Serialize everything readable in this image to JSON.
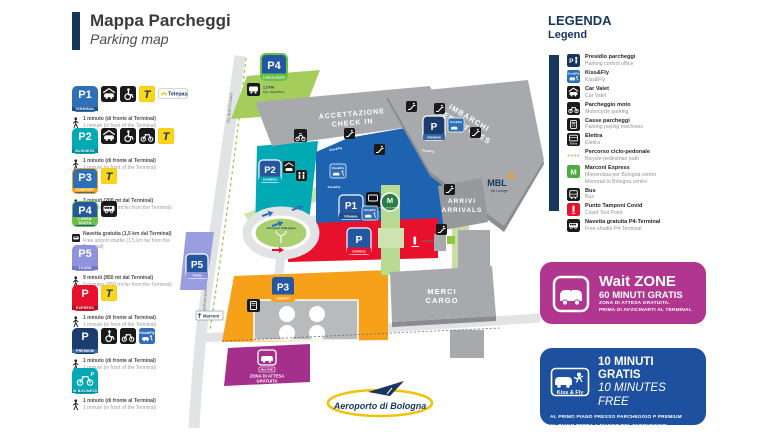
{
  "title": {
    "it": "Mappa Parcheggi",
    "en": "Parking map"
  },
  "labels": {
    "telepass_badge": "Telepass",
    "telepass_t": "T",
    "kissfly": "Kiss&Fly",
    "elettra": "Elettra",
    "marconi_m": "M",
    "office_p": "P",
    "kissfly_spaced": "Kiss & Fly"
  },
  "colors": {
    "navy": "#17365d",
    "p1_blue": "#1e63b0",
    "p2_teal": "#00aab4",
    "p3_orange": "#f7a11a",
    "p4_green": "#6cc04a",
    "p5_periwinkle": "#9a9de0",
    "express_red": "#e8112d",
    "premium_navy": "#1d3c6e",
    "wait_magenta": "#b0368f",
    "banner_blue": "#1d509f",
    "telepass_yellow": "#ffd41c",
    "building_gray": "#a7a9ac",
    "road_gray": "#e2e3e4",
    "bike_green": "#8dc63f"
  },
  "sidebar": {
    "entries": [
      {
        "sign": "P1",
        "caption": "TERMINAL",
        "bg": "#2e6fb7",
        "cap_bg": "#1d4f8c",
        "border": "",
        "type": "p",
        "icons": [
          "car-valet",
          "wheelchair",
          "telepass-t",
          "telepass-badge"
        ],
        "text_icon": "walk",
        "line_it": "1 minuto (di fronte al Terminal)",
        "line_en": "1 minute (in front of the Terminal)"
      },
      {
        "sign": "P2",
        "caption": "BUSINESS",
        "bg": "#00a9b4",
        "cap_bg": "#00889b",
        "border": "",
        "type": "p",
        "icons": [
          "car-valet",
          "wheelchair",
          "motorcycle",
          "telepass-t"
        ],
        "text_icon": "walk",
        "line_it": "1 minuto (di fronte al Terminal)",
        "line_en": "1 minute (in front of the Terminal)"
      },
      {
        "sign": "P3",
        "caption": "COMFORT",
        "bg": "#2e6fb7",
        "cap_bg": "#f5a21b",
        "border": "#f5a21b",
        "type": "p",
        "icons": [
          "telepass-t"
        ],
        "text_icon": "walk",
        "line_it": "3 minuti (200 mt dal Terminal)",
        "line_en": "3 minutes (200 mt far from the Terminal)"
      },
      {
        "sign": "P4",
        "caption": "LUNGA SOSTA",
        "bg": "#2457a0",
        "cap_bg": "#6cc04a",
        "border": "#6cc04a",
        "type": "p",
        "icons": [
          "shuttle"
        ],
        "text_icon": "shuttle",
        "line_it": "Navetta gratuita (1,5 km dal Terminal)",
        "line_en": "Free airport shuttle (1,5 km far from the Terminal)"
      },
      {
        "sign": "P5",
        "caption": "TOURS",
        "bg": "#8f93dd",
        "cap_bg": "#7478c9",
        "border": "",
        "type": "p",
        "icons": [],
        "text_icon": "walk",
        "line_it": "9 minuti (850 mt dal Terminal)",
        "line_en": "9 minutes (850 mt far from the Terminal)"
      },
      {
        "sign": "P",
        "caption": "EXPRESS",
        "bg": "#e8112d",
        "cap_bg": "#b30d22",
        "border": "",
        "type": "p",
        "icons": [
          "telepass-t"
        ],
        "text_icon": "walk",
        "line_it": "1 minuto (di fronte al Terminal)",
        "line_en": "1 minute (in front of the Terminal)"
      },
      {
        "sign": "P",
        "caption": "PREMIUM",
        "bg": "#1d3c6e",
        "cap_bg": "#35669f",
        "border": "",
        "type": "p",
        "icons": [
          "wheelchair",
          "motorcycle",
          "kissfly"
        ],
        "text_icon": "walk",
        "line_it": "1 minuto (di fronte al Terminal)",
        "line_en": "1 minute (in front of the Terminal)"
      },
      {
        "sign": "moto",
        "caption": "IN BUSINESS",
        "bg": "#00a9b4",
        "cap_bg": "#00889b",
        "border": "",
        "type": "moto",
        "icons": [],
        "text_icon": "walk",
        "line_it": "1 minuto (di fronte al Terminal)",
        "line_en": "1 minute (in front of the Terminal)"
      }
    ]
  },
  "legend": {
    "title_it": "LEGENDA",
    "title_en": "Legend",
    "items": [
      {
        "icon": "parking-office",
        "it": "Presidio parcheggi",
        "en": "Parking control office"
      },
      {
        "icon": "kissfly",
        "it": "Kiss&Fly",
        "en": "Kiss&Fly"
      },
      {
        "icon": "car-valet",
        "it": "Car Valet",
        "en": "Car Valet"
      },
      {
        "icon": "motorcycle",
        "it": "Parcheggio moto",
        "en": "Motorcycle parking"
      },
      {
        "icon": "pay-machine",
        "it": "Casse parcheggi",
        "en": "Parking paying machines"
      },
      {
        "icon": "elettra",
        "it": "Elettra",
        "en": "Elettra"
      },
      {
        "icon": "bike-path",
        "it": "Percorso ciclo-pedonale",
        "en": "Bicycle-pedestrian path"
      },
      {
        "icon": "marconi",
        "it": "Marconi Express",
        "en": "Monorotaia per Bologna centro",
        "en2": "Monorail to Bologna centre"
      },
      {
        "icon": "bus",
        "it": "Bus",
        "en": "Bus"
      },
      {
        "icon": "covid",
        "it": "Punto Tamponi Covid",
        "en": "Covid Test Point"
      },
      {
        "icon": "shuttle",
        "it": "Navetta gratuita P4-Terminal",
        "en": "Free shuttle P4-Terminal"
      }
    ]
  },
  "wait_zone": {
    "title": "Wait ZONE",
    "line1": "60 MINUTI GRATIS",
    "line2": "ZONA DI ATTESA GRATUITA.",
    "line3": "PRIMA DI AVVICINARTI AL TERMINAL"
  },
  "kiss_fly_card": {
    "badge": "Kiss & Fly",
    "title": "10 MINUTI GRATIS",
    "subtitle": "10 MINUTES FREE",
    "note1": "AL PRIMO PIANO PRESSO PARCHEGGIO P PREMIUM",
    "note2": "AL PIANO TERRA A FIANCO DEL PARCHEGGIO",
    "note3": "P1 TERMINAL CON ACCESSI DEDICATI"
  },
  "map": {
    "roads": {
      "via_fornace": "Via della Fornace",
      "via_aeroporto": "Via dell'Aeroporto"
    },
    "buildings": {
      "checkin_1": "ACCETTAZIONE",
      "checkin_2": "CHECK IN",
      "departures_1": "IMBARCHI",
      "departures_2": "DEPARTURES",
      "arrivals_1": "ARRIVI",
      "arrivals_2": "ARRIVALS",
      "cargo_1": "MERCI",
      "cargo_2": "CARGO"
    },
    "signs": {
      "p1": "P1",
      "p1_caption": "TERMINAL",
      "p2": "P2",
      "p2_caption": "BUSINESS",
      "p3": "P3",
      "p3_caption": "COMFORT",
      "p4": "P4",
      "p4_caption": "LUNGA SOSTA",
      "p5": "P5",
      "p5_caption": "TOURS",
      "p_express": "P",
      "p_express_caption": "EXPRESS",
      "p_premium": "P",
      "p_premium_caption": "PREMIUM"
    },
    "labels": {
      "p4_shuttle_1": "1,5 KM",
      "p4_shuttle_2": "DAL TERMINAL",
      "kissfly": "Kiss&Fly",
      "elettra": "Elettra",
      "marconi_express": "MARCONI EXPRESS",
      "mbl": "MBL",
      "mbl_sub": "Vip Lounge",
      "wait_area_1": "ZONA DI ATTESA",
      "wait_area_2": "GRATUITA",
      "direction_sign": "Marconi"
    },
    "logo": {
      "name": "Aeroporto di Bologna"
    }
  }
}
